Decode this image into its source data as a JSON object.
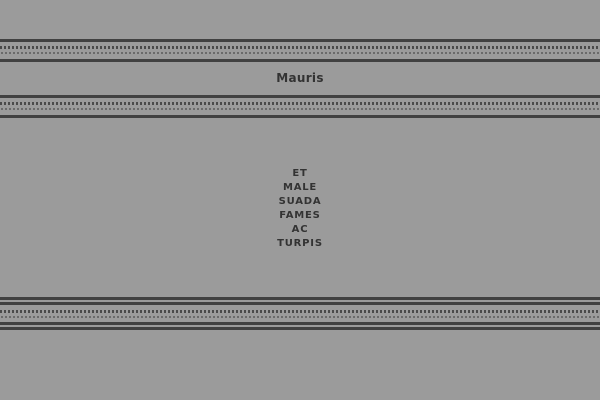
{
  "theme": {
    "background_color": "#9b9b9b",
    "text_color": "#333333",
    "ornament_line_color": "#414141",
    "ornament_square_color": "#4a4a4a",
    "ornament_dot_color": "#6a6a6a"
  },
  "header": {
    "title": "Mauris"
  },
  "content": {
    "lines": [
      "ET",
      "MALE",
      "SUADA",
      "FAMES",
      "AC",
      "TURPIS"
    ],
    "full_text": "ET MALE SUADA FAMES AC TURPIS"
  }
}
